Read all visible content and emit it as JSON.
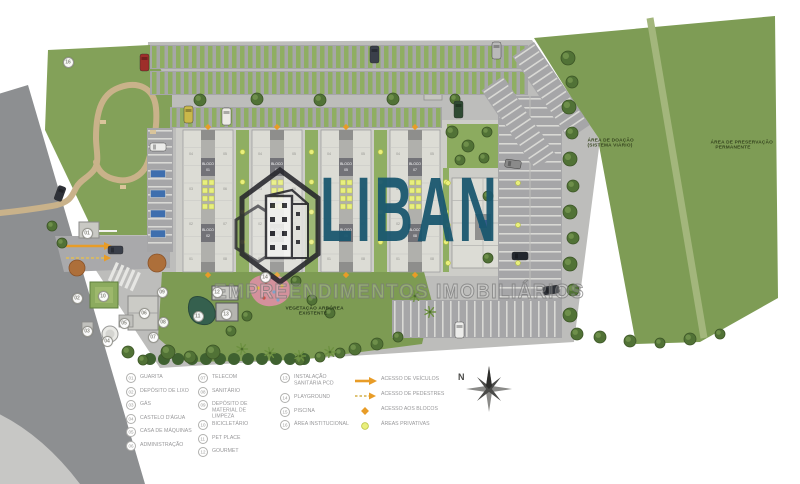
{
  "watermark": {
    "brand": "LIBAN",
    "subtitle": "EMPREENDIMENTOS IMOBILIÁRIOS"
  },
  "plan": {
    "compass_north": "N",
    "area_labels": {
      "doacao": {
        "line1": "ÁREA DE DOAÇÃO",
        "line2": "(SISTEMA VIÁRIO)"
      },
      "preservacao": {
        "line1": "ÁREA DE PRESERVAÇÃO",
        "line2": "PERMANENTE"
      },
      "vegetacao": {
        "line1": "VEGETAÇÃO ARBÓREA",
        "line2": "EXISTENTE"
      }
    },
    "bloco_labels": [
      "BLOCO 01",
      "BLOCO 02",
      "BLOCO 03",
      "BLOCO 04",
      "BLOCO 05",
      "BLOCO 06",
      "BLOCO 07",
      "BLOCO 08"
    ],
    "unit_labels_left": [
      "04",
      "03",
      "02",
      "01"
    ],
    "unit_labels_right": [
      "05",
      "06",
      "07",
      "08"
    ],
    "markers": [
      {
        "num": "16",
        "x": 68,
        "y": 62
      },
      {
        "num": "01",
        "x": 87,
        "y": 233
      },
      {
        "num": "02",
        "x": 77,
        "y": 298
      },
      {
        "num": "10",
        "x": 103,
        "y": 296
      },
      {
        "num": "03",
        "x": 87,
        "y": 331
      },
      {
        "num": "04",
        "x": 107,
        "y": 341
      },
      {
        "num": "05",
        "x": 124,
        "y": 323
      },
      {
        "num": "06",
        "x": 144,
        "y": 313
      },
      {
        "num": "07",
        "x": 153,
        "y": 337
      },
      {
        "num": "08",
        "x": 163,
        "y": 322
      },
      {
        "num": "09",
        "x": 162,
        "y": 292
      },
      {
        "num": "11",
        "x": 198,
        "y": 316
      },
      {
        "num": "12",
        "x": 217,
        "y": 292
      },
      {
        "num": "13",
        "x": 226,
        "y": 314
      },
      {
        "num": "14",
        "x": 265,
        "y": 277
      }
    ]
  },
  "legend": {
    "items": [
      {
        "num": "01",
        "label": "GUARITA"
      },
      {
        "num": "02",
        "label": "DEPÓSITO DE LIXO"
      },
      {
        "num": "03",
        "label": "GÁS"
      },
      {
        "num": "04",
        "label": "CASTELO D'ÁGUA"
      },
      {
        "num": "05",
        "label": "CASA DE MÁQUINAS"
      },
      {
        "num": "06",
        "label": "ADMINISTRAÇÃO"
      },
      {
        "num": "07",
        "label": "TELECOM"
      },
      {
        "num": "08",
        "label": "SANITÁRIO"
      },
      {
        "num": "09",
        "label": "DEPÓSITO DE MATERIAL DE LIMPEZA"
      },
      {
        "num": "10",
        "label": "BICICLETÁRIO"
      },
      {
        "num": "11",
        "label": "PET PLACE"
      },
      {
        "num": "12",
        "label": "GOURMET"
      },
      {
        "num": "13",
        "label": "INSTALAÇÃO SANITÁRIA PCD"
      },
      {
        "num": "14",
        "label": "PLAYGROUND"
      },
      {
        "num": "15",
        "label": "PISCINA"
      },
      {
        "num": "16",
        "label": "ÁREA INSTITUCIONAL"
      }
    ],
    "access": [
      {
        "type": "arrow-solid",
        "label": "ACESSO DE VEÍCULOS"
      },
      {
        "type": "arrow-dashed",
        "label": "ACESSO DE PEDESTRES"
      },
      {
        "type": "diamond",
        "label": "ACESSO AOS BLOCOS"
      },
      {
        "type": "circle",
        "label": "ÁREAS PRIVATIVAS"
      }
    ]
  },
  "colors": {
    "brand": "#19576f",
    "accent_orange": "#e89c27",
    "private_yellow": "#e9ef7d",
    "field_green": "#7e9c55",
    "water": "#35604e"
  }
}
